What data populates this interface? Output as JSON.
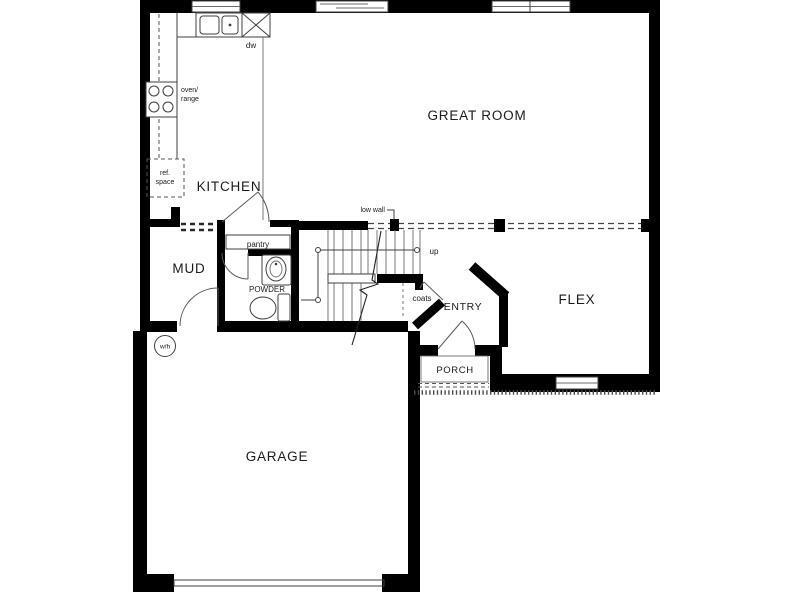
{
  "plan": {
    "type": "first-floor residential floor plan",
    "rooms": {
      "great_room": "GREAT ROOM",
      "kitchen": "KITCHEN",
      "mud": "MUD",
      "powder": "POWDER",
      "flex": "FLEX",
      "entry": "ENTRY",
      "porch": "PORCH",
      "garage": "GARAGE"
    },
    "labels": {
      "dishwasher": "dw",
      "oven_line1": "oven/",
      "oven_line2": "range",
      "ref_line1": "ref.",
      "ref_line2": "space",
      "pantry": "pantry",
      "low_wall": "low wall",
      "up": "up",
      "coats": "coats",
      "water_heater": "w/h"
    },
    "colors": {
      "wall": "#000000",
      "line": "#3f3f3f",
      "text": "#1b1b1b",
      "background": "#ffffff"
    }
  }
}
